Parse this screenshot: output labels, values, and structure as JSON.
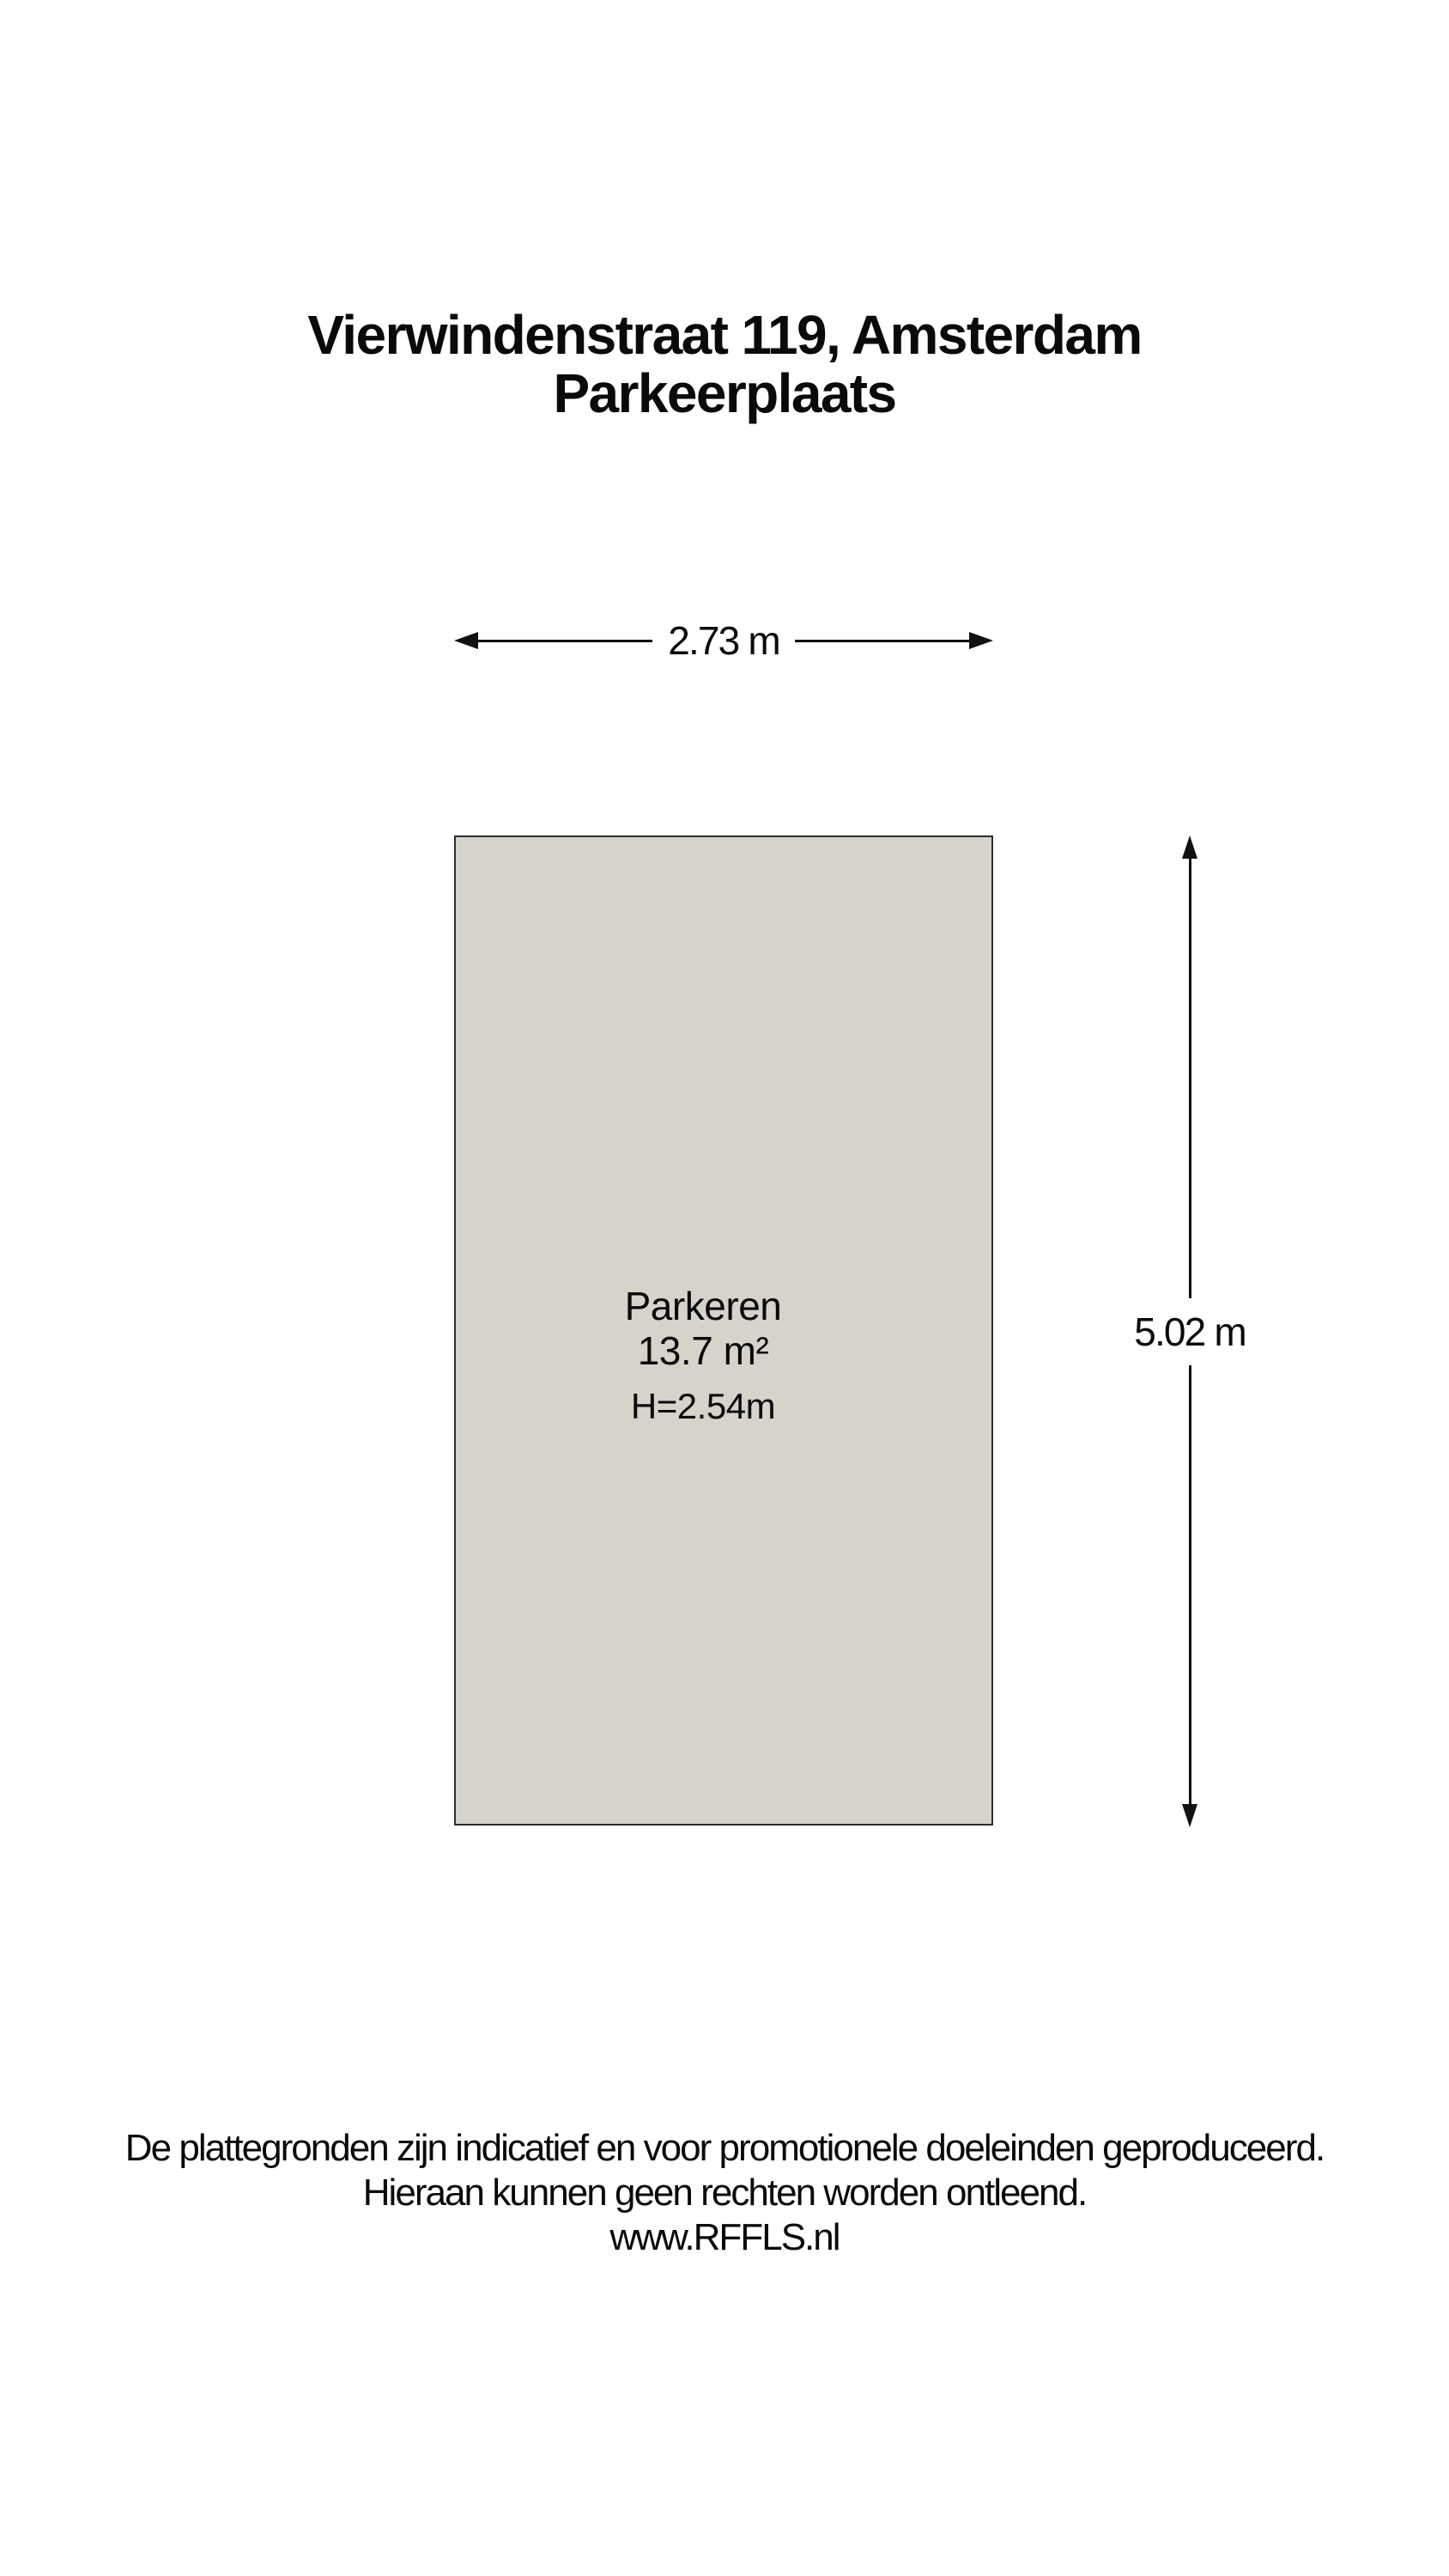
{
  "colors": {
    "background": "#ffffff",
    "room_fill": "#d6d3cb",
    "room_border": "#2e2e2e",
    "line": "#111111",
    "text": "#0a0a0a"
  },
  "title": {
    "line1": "Vierwindenstraat 119, Amsterdam",
    "line2": "Parkeerplaats"
  },
  "plan": {
    "width_dimension": {
      "label": "2.73 m"
    },
    "height_dimension": {
      "label": "5.02 m"
    },
    "room": {
      "name": "Parkeren",
      "area": "13.7 m²",
      "ceiling_height": "H=2.54m"
    }
  },
  "footer": {
    "line1": "De plattegronden zijn indicatief en voor promotionele doeleinden geproduceerd.",
    "line2": "Hieraan kunnen geen rechten worden ontleend.",
    "line3": "www.RFFLS.nl"
  }
}
